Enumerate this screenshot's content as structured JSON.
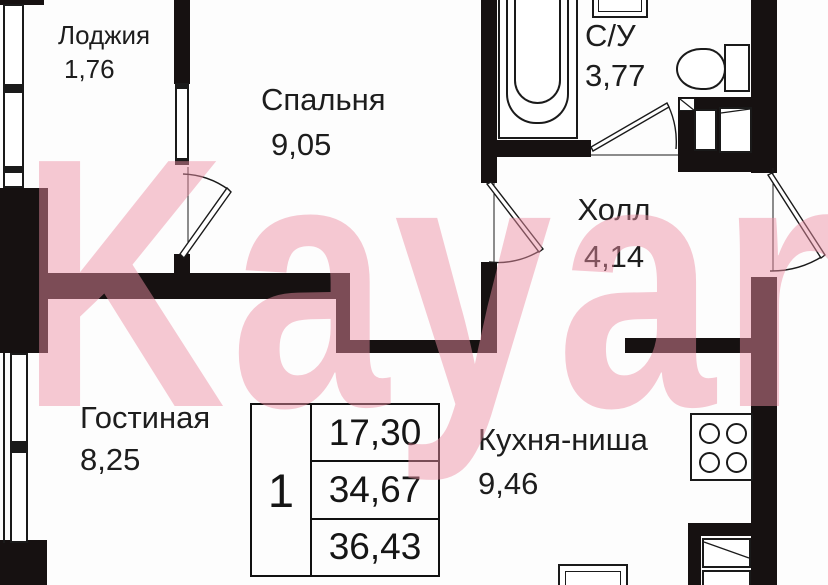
{
  "watermark": {
    "text": "Kayan",
    "color": "#ec8fa2"
  },
  "rooms": [
    {
      "id": "loggia",
      "name": "Лоджия",
      "area": "1,76"
    },
    {
      "id": "bedroom",
      "name": "Спальня",
      "area": "9,05"
    },
    {
      "id": "bathroom",
      "name": "С/У",
      "area": "3,77"
    },
    {
      "id": "hall",
      "name": "Холл",
      "area": "4,14"
    },
    {
      "id": "living",
      "name": "Гостиная",
      "area": "8,25"
    },
    {
      "id": "kitchen",
      "name": "Кухня-ниша",
      "area": "9,46"
    }
  ],
  "info_table": {
    "rooms_count": "1",
    "living_area": "17,30",
    "apartment_area": "34,67",
    "total_area": "36,43"
  }
}
